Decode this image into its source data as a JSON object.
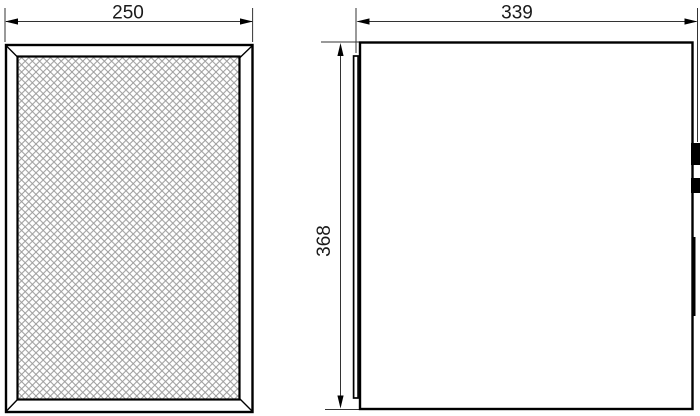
{
  "drawing": {
    "background_color": "#ffffff",
    "object_line_color": "#000000",
    "dimension_line_color": "#333333",
    "mesh_line_color": "#9b9b9b",
    "dimensions": {
      "front_width": {
        "label": "250",
        "orientation": "horizontal"
      },
      "side_depth": {
        "label": "339",
        "orientation": "horizontal"
      },
      "side_height": {
        "label": "368",
        "orientation": "vertical"
      }
    }
  }
}
